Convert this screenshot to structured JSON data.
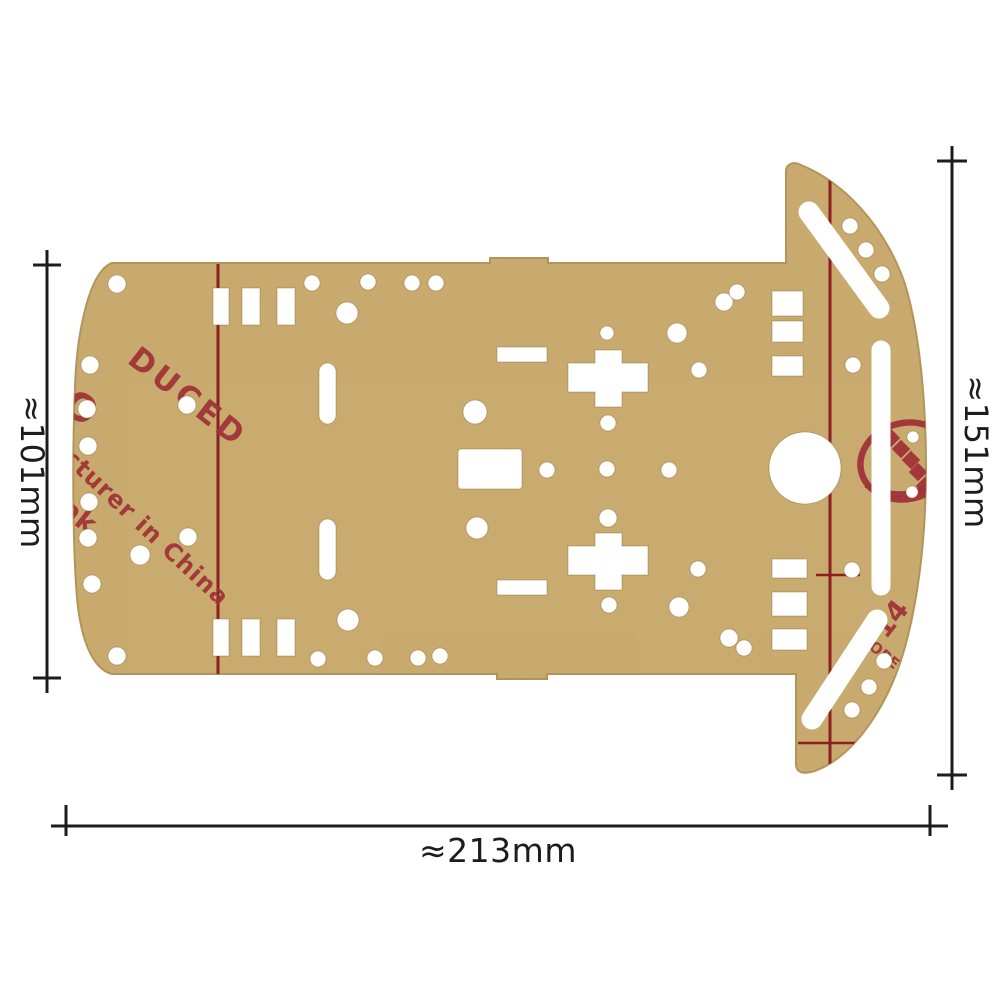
{
  "dimensions": {
    "left_height_label": "≈101mm",
    "right_height_label": "≈151mm",
    "bottom_width_label": "≈213mm"
  },
  "watermark": {
    "fragment_produced": "DUCED",
    "fragment_o": "O",
    "fragment_ak": "ak",
    "fragment_manufacturer": "cturer in China",
    "fragment_number": "14",
    "fragment_ope": "OPE"
  },
  "colors": {
    "background": "#ffffff",
    "plate": "#c9ab6f",
    "plate_edge": "#b3945a",
    "stamp_red": "#a03238",
    "line_red": "#8c1f1f",
    "dimension_black": "#1c1c1c"
  }
}
